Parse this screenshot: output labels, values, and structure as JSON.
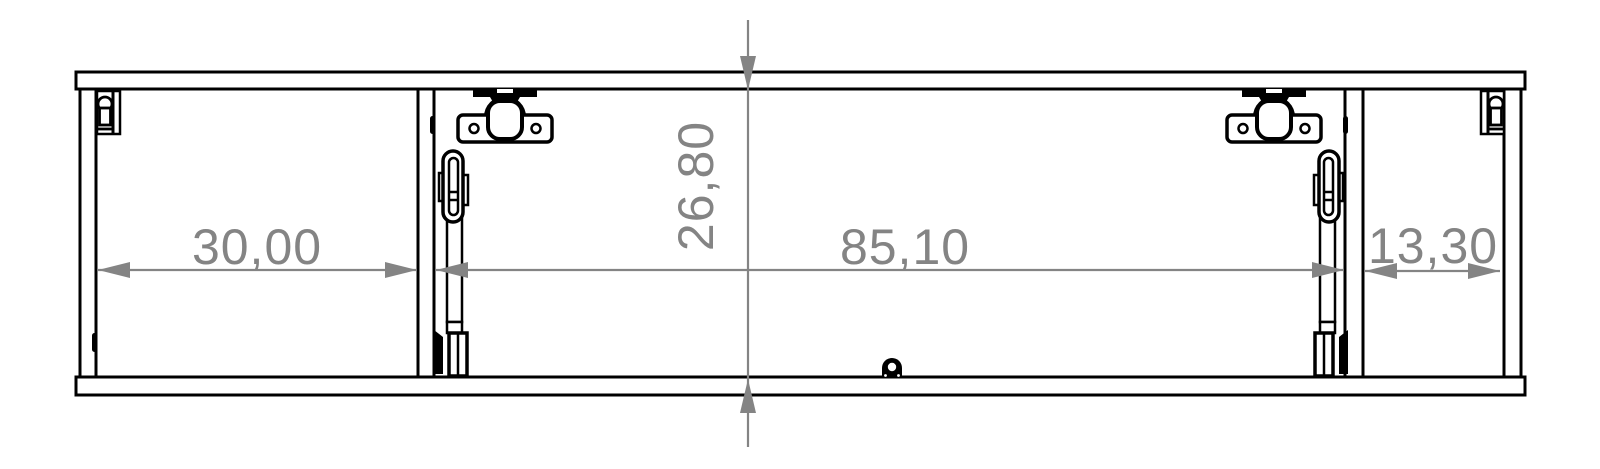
{
  "drawing": {
    "kind": "cabinet-front-section-technical-drawing",
    "colors": {
      "background": "#ffffff",
      "outline": "#000000",
      "dimension": "#848484"
    },
    "dimensions": {
      "left_compartment_width": "30,00",
      "cabinet_height": "26,80",
      "center_compartment_width": "85,10",
      "right_compartment_width": "13,30"
    }
  }
}
